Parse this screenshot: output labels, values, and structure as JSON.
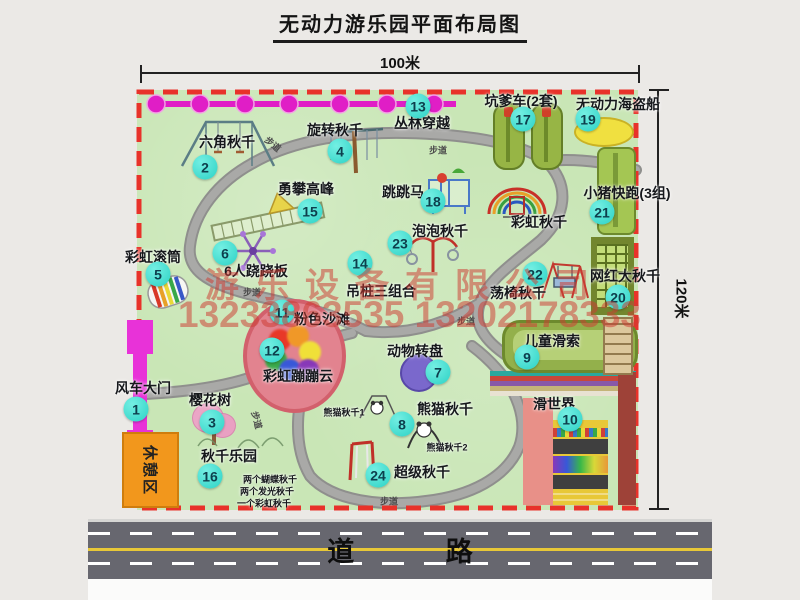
{
  "title": "无动力游乐园平面布局图",
  "dim_width": "100米",
  "dim_height": "120米",
  "road_label": "道 路",
  "path_label": "步道",
  "rest_area_label": "休憩区",
  "watermark": {
    "line1": "游乐设备有限公司",
    "line2": "13233863535 13202178333"
  },
  "rainbow_swing_label": "彩虹秋千",
  "panda_sub1": "熊猫秋千1",
  "panda_sub2": "熊猫秋千2",
  "swing_park_details": [
    "两个蝴蝶秋千",
    "两个发光秋千",
    "一个彩虹秋千"
  ],
  "colors": {
    "border_red": "#e8322a",
    "badge_teal": "#2cd2c5",
    "park_green": "#c9e6b6",
    "path_gray": "#9d9d9d",
    "zipline_magenta": "#e01ec6",
    "gate_magenta": "#e832d8",
    "rest_orange": "#f2971c",
    "road_gray": "#67676f",
    "watermark_red": "#cd3c32"
  },
  "attractions": [
    {
      "num": "1",
      "name": "风车大门"
    },
    {
      "num": "2",
      "name": "六角秋千"
    },
    {
      "num": "3",
      "name": "樱花树"
    },
    {
      "num": "4",
      "name": "旋转秋千"
    },
    {
      "num": "5",
      "name": "彩虹滚筒"
    },
    {
      "num": "6",
      "name": "6人跷跷板"
    },
    {
      "num": "7",
      "name": "动物转盘"
    },
    {
      "num": "8",
      "name": "熊猫秋千"
    },
    {
      "num": "9",
      "name": "儿童滑索"
    },
    {
      "num": "10",
      "name": "滑世界"
    },
    {
      "num": "11",
      "name": "粉色沙滩"
    },
    {
      "num": "12",
      "name": "彩虹蹦蹦云"
    },
    {
      "num": "13",
      "name": "丛林穿越"
    },
    {
      "num": "14",
      "name": "吊桩三组合"
    },
    {
      "num": "15",
      "name": "勇攀高峰"
    },
    {
      "num": "16",
      "name": "秋千乐园"
    },
    {
      "num": "17",
      "name": "坑爹车(2套)"
    },
    {
      "num": "18",
      "name": "跳跳马"
    },
    {
      "num": "19",
      "name": "无动力海盗船"
    },
    {
      "num": "20",
      "name": "网红大秋千"
    },
    {
      "num": "21",
      "name": "小猪快跑(3组)"
    },
    {
      "num": "22",
      "name": "荡椅秋千"
    },
    {
      "num": "23",
      "name": "泡泡秋千"
    },
    {
      "num": "24",
      "name": "超级秋千"
    }
  ]
}
